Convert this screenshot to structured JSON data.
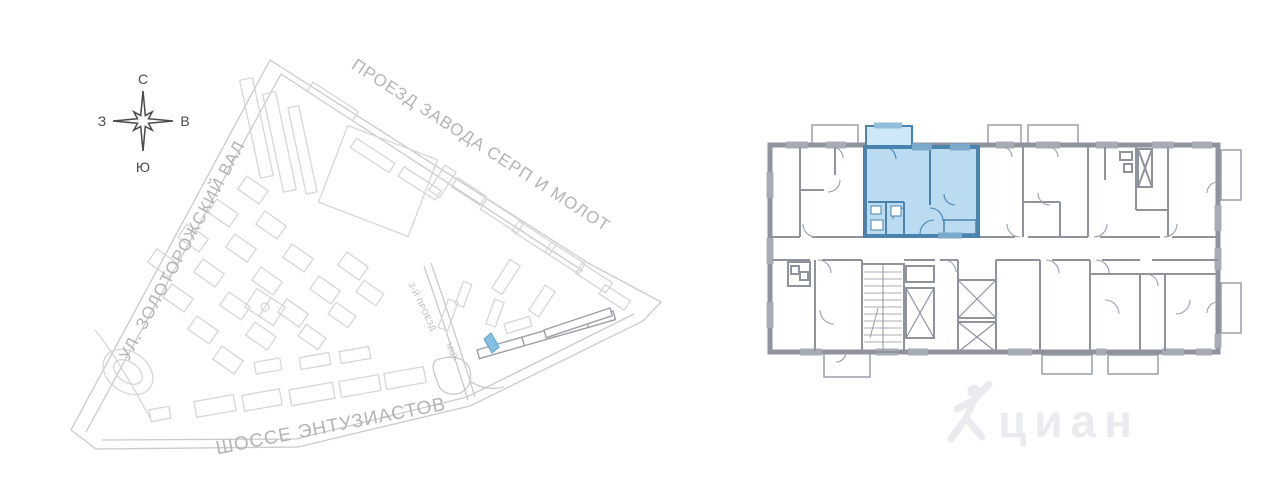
{
  "page": {
    "background": "#ffffff"
  },
  "compass": {
    "north": "С",
    "south": "Ю",
    "west": "З",
    "east": "В"
  },
  "map": {
    "street_top": "ПРОЕЗД ЗАВОДА СЕРП И МОЛОТ",
    "street_left": "УЛ. ЗОЛОТОРОЖСКИЙ ВАЛ",
    "street_bottom": "ШОССЕ ЭНТУЗИАСТОВ",
    "street_small": "3-Й ПРОЕЗД",
    "railway_label": "МЦК",
    "outline_color": "#d5d6d8",
    "road_color": "#c9cacd",
    "label_color": "#b3b4b6",
    "highlight_color": "#85c1e5",
    "subject_building_color": "#9ba0a7"
  },
  "floor_plan": {
    "wall_color": "#8e939c",
    "window_color": "#a7acb4",
    "highlight_fill": "#b5d9ef",
    "highlight_balcony_fill": "#cfe8f7",
    "highlight_wall": "#4a83ad"
  },
  "watermark": {
    "text": "циан",
    "color": "#e9ebee"
  }
}
